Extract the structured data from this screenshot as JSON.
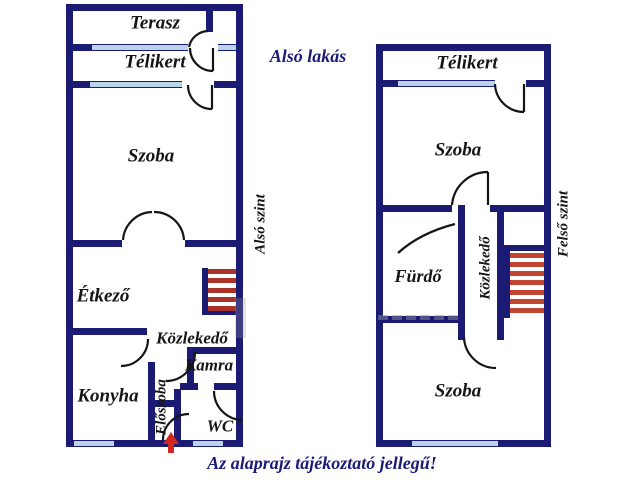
{
  "header": {
    "title": "Alsó lakás"
  },
  "footer": {
    "disclaimer": "Az alaprajz tájékoztató jellegű!"
  },
  "left_plan": {
    "level_label": "Alsó szint",
    "rooms": {
      "terasz": "Terasz",
      "telikert": "Télikert",
      "szoba": "Szoba",
      "etkezo": "Étkező",
      "kozlekedo": "Közlekedő",
      "kamra": "Kamra",
      "konyha": "Konyha",
      "eloszoba": "Előszoba",
      "wc": "WC"
    }
  },
  "right_plan": {
    "level_label": "Felső szint",
    "rooms": {
      "telikert": "Télikert",
      "szoba_upper": "Szoba",
      "furdo": "Fürdő",
      "kozlekedo": "Közlekedő",
      "szoba_lower": "Szoba"
    }
  },
  "stairs": {
    "left_treads": 5,
    "right_treads": 7
  },
  "colors": {
    "wall": "#1b1b73",
    "window": "#b9d3e8",
    "stair_left": "#a93328",
    "stair_right": "#c04532",
    "ink": "#151515",
    "navy_text": "#1a1a78",
    "arrow": "#d3281e"
  }
}
